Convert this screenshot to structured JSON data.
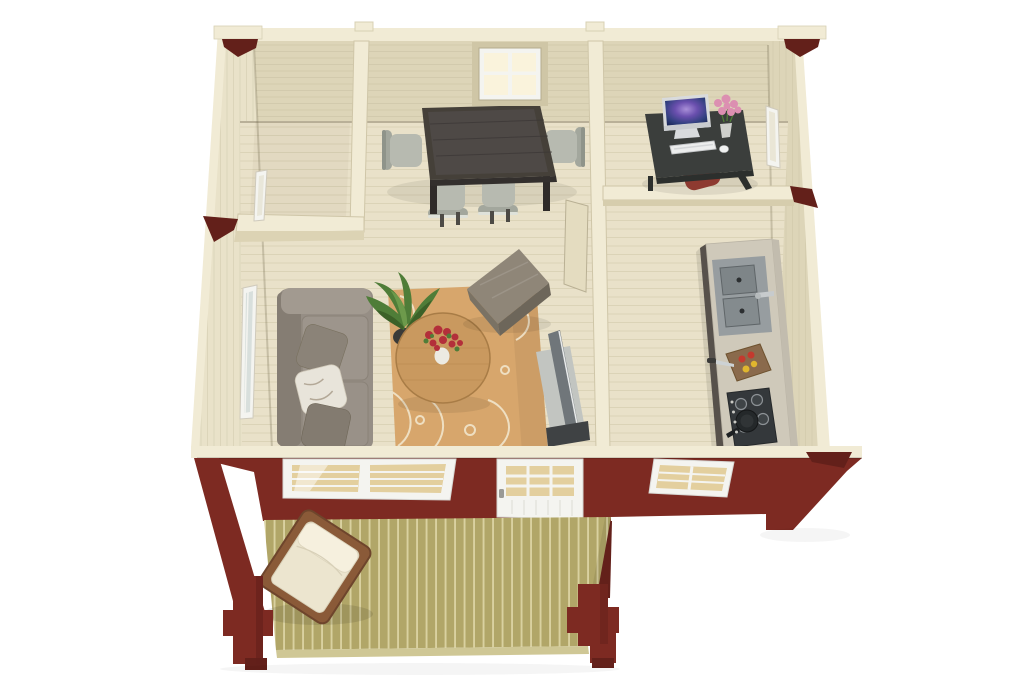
{
  "scene": {
    "type": "3d-floor-plan-render",
    "description": "Top-down 3D render of a small log cabin: furnished interior (dining room, office, living room, kitchen, empty small room) with dark-red front facade, white windows and glazed door, and a front deck with one chair",
    "background": "#ffffff"
  },
  "palette": {
    "wall_wood": "#ddd5b8",
    "wall_wood_light": "#e9e2c9",
    "wall_top_edge": "#f1ebd5",
    "wall_line": "#c8bfa1",
    "floor_wood": "#e9e1c9",
    "floor_line": "#d7cfb2",
    "red_wall": "#7d2a22",
    "red_dark": "#63201a",
    "deck_wood": "#b1a668",
    "deck_line": "#ded6a6",
    "deck_edge": "#cfc795",
    "white_frame": "#f4f4f0",
    "glass_tan": "#e3cf9e",
    "glass_warm": "#faf3dc",
    "table_dark": "#454039",
    "chair_grey": "#b7bab0",
    "sofa_grey": "#968e85",
    "pillow_white": "#e8e4da",
    "rug_tan": "#d7a66c",
    "rug_pattern": "#f3e9d2",
    "oak": "#c9995f",
    "ottoman_top": "#8f8678",
    "ottoman_side": "#6d665a",
    "tv_grey": "#70767a",
    "tv_base": "#c2c5c1",
    "counter_top": "#cfc9ba",
    "counter_side": "#57514b",
    "sink_grey": "#979da0",
    "hob_dark": "#34383b",
    "pan_black": "#24282a",
    "board_brown": "#8a6a4c",
    "tomato_red": "#c43a2e",
    "lemon_yellow": "#e0b62e",
    "plant_green": "#4f7d38",
    "pot_dark": "#3a3a38",
    "flower_red": "#b32f3a",
    "flower_pink": "#dc8fb1",
    "desk_dark": "#3b3e3c",
    "silver": "#d9dbdd",
    "chair_red": "#8e3a30",
    "deck_chair_wood": "#8a5a38",
    "cushion_ivory": "#ece5cf"
  },
  "rooms": [
    {
      "name": "small-room",
      "furniture": []
    },
    {
      "name": "dining-room",
      "furniture": [
        "dining-table",
        "chair",
        "chair",
        "chair",
        "chair"
      ],
      "windows": [
        "back-wall-window"
      ]
    },
    {
      "name": "office",
      "furniture": [
        "desk",
        "imac-computer",
        "keyboard",
        "mouse",
        "pink-flowers",
        "red-chair"
      ],
      "windows": [
        "right-wall-window"
      ]
    },
    {
      "name": "living-room",
      "furniture": [
        "sofa",
        "pillow",
        "pillow",
        "pillow",
        "potted-plant",
        "round-coffee-table",
        "red-flower-bouquet",
        "patterned-rug",
        "ottoman",
        "tv",
        "tv-stand"
      ],
      "windows": [
        "left-wall-window"
      ]
    },
    {
      "name": "kitchen",
      "furniture": [
        "counter",
        "double-sink",
        "faucet",
        "cutting-board",
        "tomatoes",
        "lemons",
        "knife",
        "gas-hob",
        "frying-pan"
      ]
    }
  ],
  "exterior": {
    "front_wall_openings": [
      "double-window",
      "glazed-door",
      "single-window"
    ],
    "deck_furniture": [
      "wooden-armchair"
    ],
    "deck_posts": 2,
    "accent_brackets": 6
  }
}
